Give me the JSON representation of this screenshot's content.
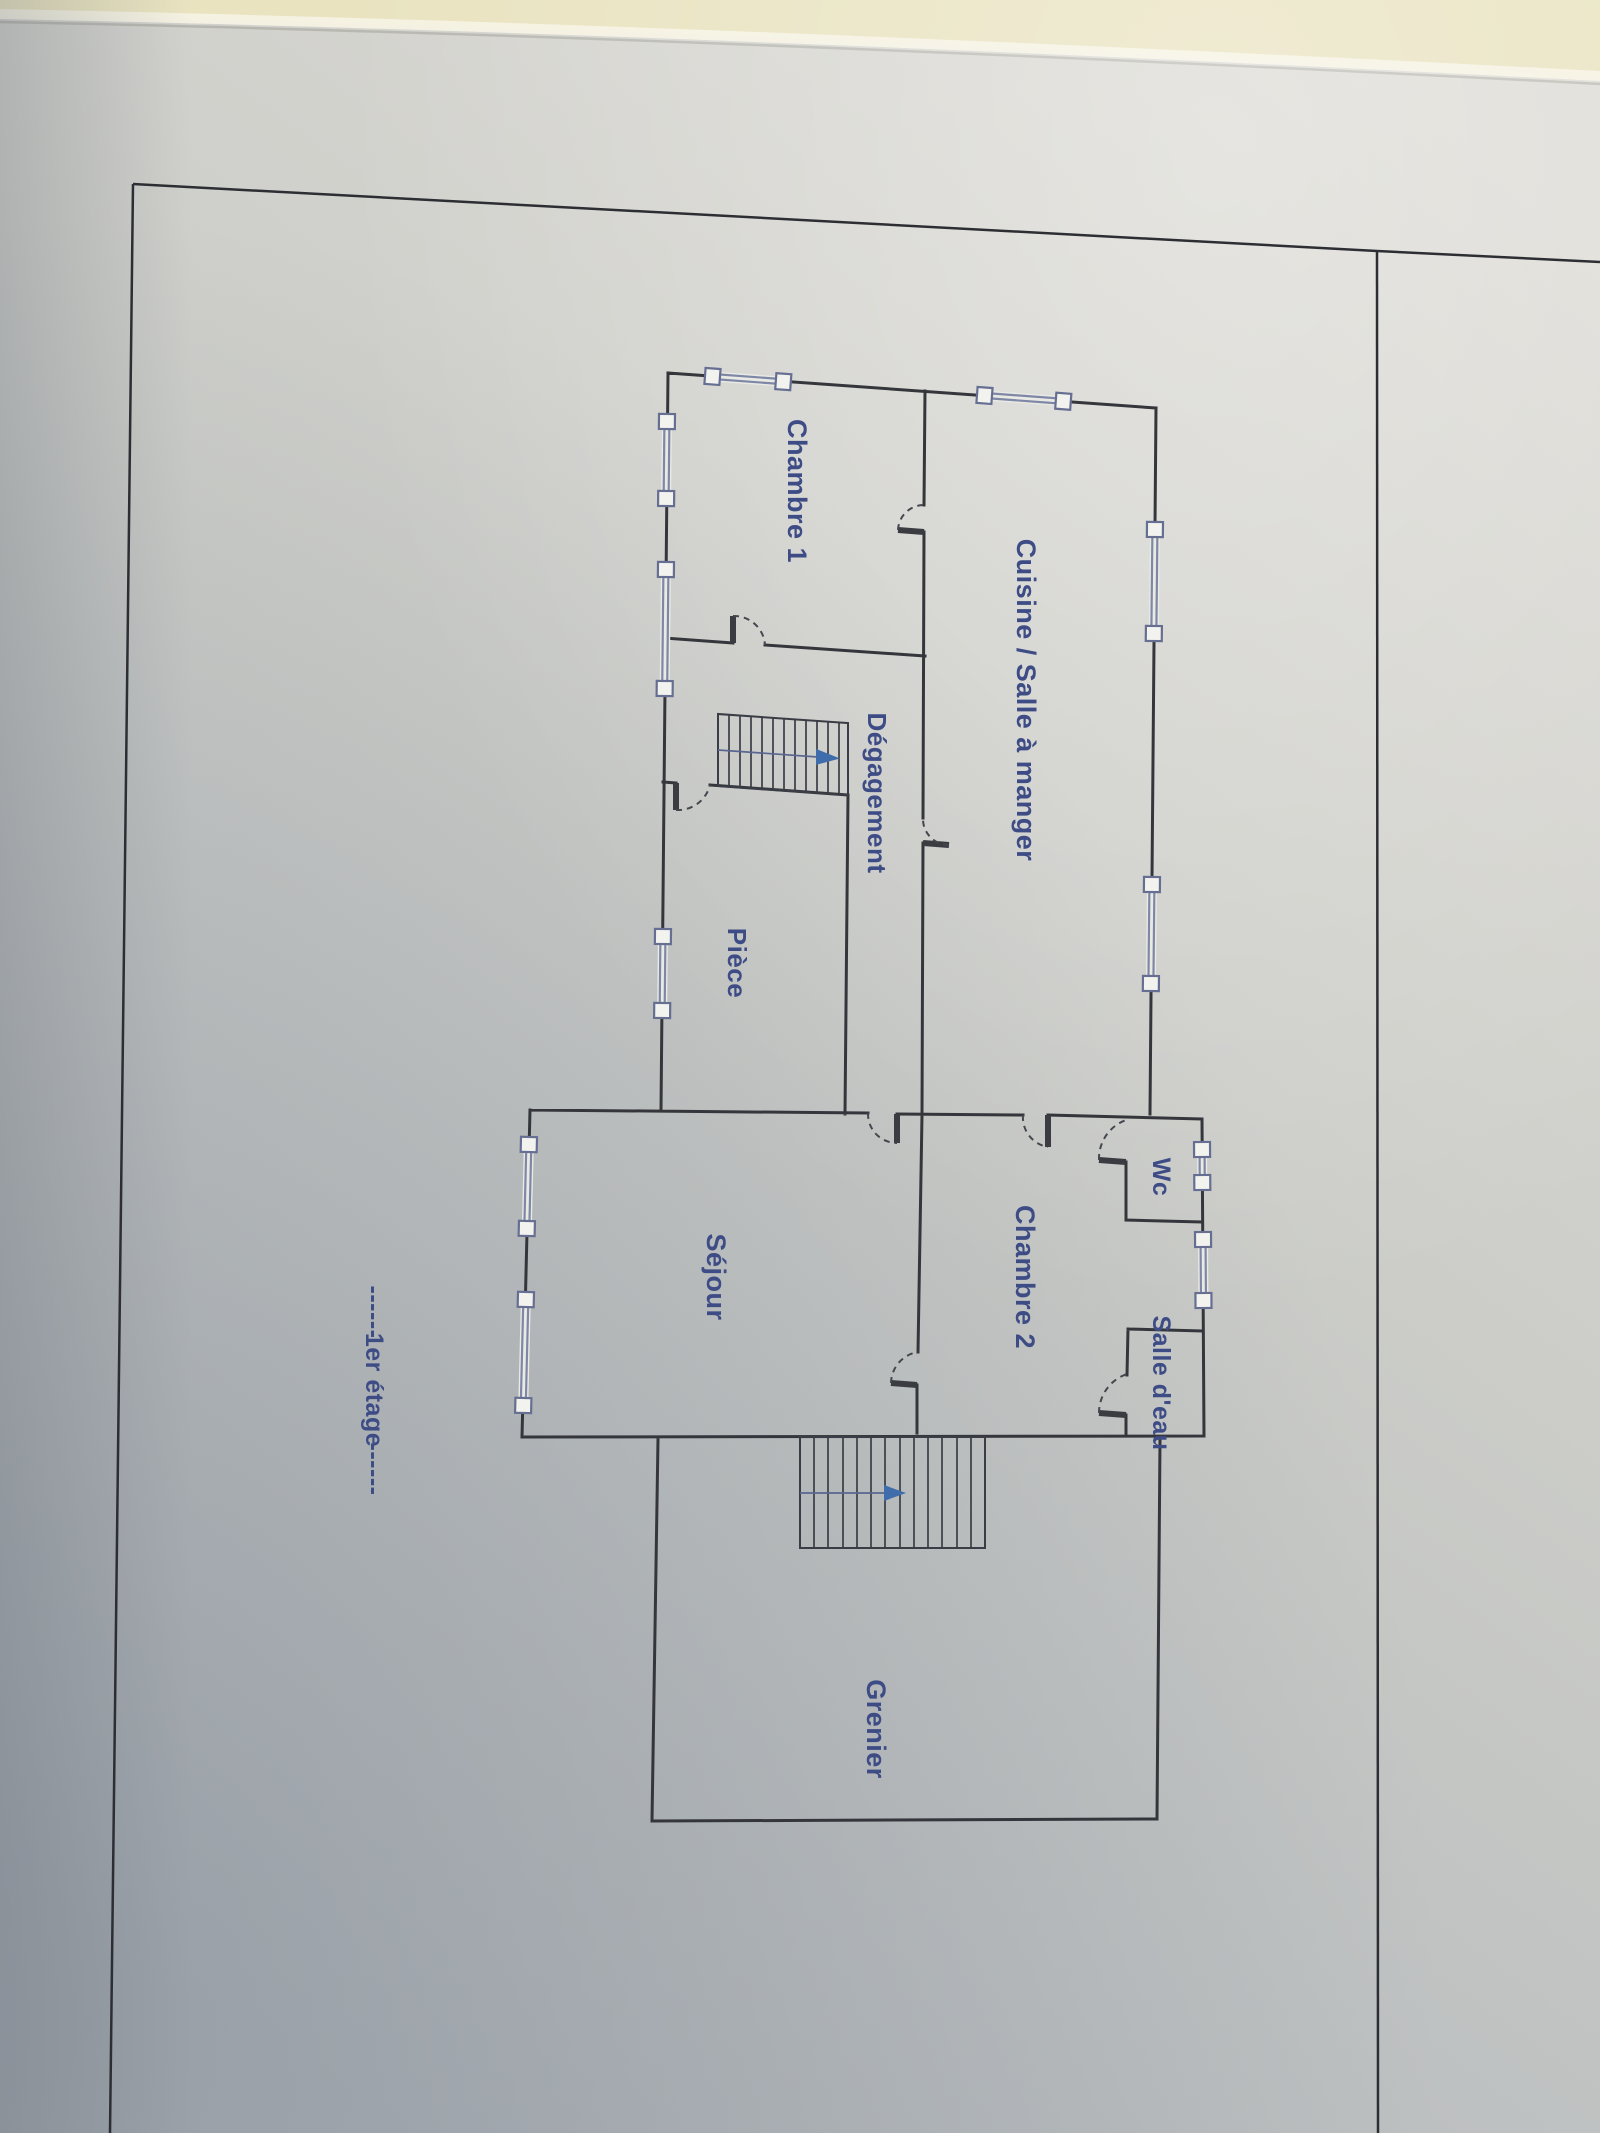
{
  "scene": {
    "description": "Photograph of a printed architectural floor plan page lying on a table",
    "floor_caption": "1er étage"
  },
  "colors": {
    "table": "#e9e3c0",
    "paper_light": "#dddcd6",
    "paper_shadow": "#b1b5ba",
    "wall_ink": "#34363b",
    "frame_ink": "#2c2e33",
    "label_blue": "#3e4c86",
    "window_blue": "#7e87a6",
    "arrow_blue": "#3f6cab"
  },
  "floor_plan": {
    "caption": {
      "prefix_dashes": "------",
      "label": "1er étage",
      "suffix_dashes": "------"
    },
    "rooms": [
      {
        "label": "Chambre 1"
      },
      {
        "label": "Cuisine / Salle à manger"
      },
      {
        "label": "Dégagement"
      },
      {
        "label": "Pièce"
      },
      {
        "label": "Séjour"
      },
      {
        "label": "Chambre 2"
      },
      {
        "label": "Wc"
      },
      {
        "label": "Salle d'eau"
      },
      {
        "label": "Grenier"
      }
    ],
    "stairs": [
      {
        "name": "upper-stair",
        "direction": "right"
      },
      {
        "name": "lower-stair",
        "direction": "right"
      }
    ],
    "window_count": 11,
    "door_count": 9
  }
}
